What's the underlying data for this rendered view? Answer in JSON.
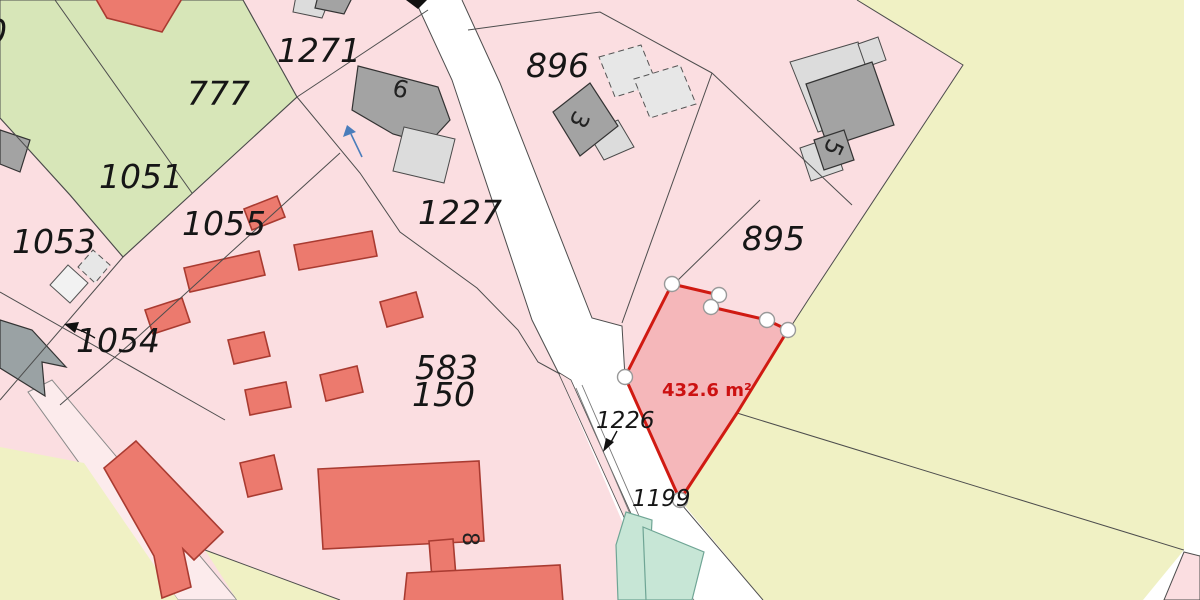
{
  "map": {
    "title": "Cadastral parcel map view",
    "parcel_labels": {
      "p0": "0",
      "p1271": "1271",
      "p777": "777",
      "p1051": "1051",
      "p1053": "1053",
      "p1054": "1054",
      "p1055": "1055",
      "p1227": "1227",
      "p896": "896",
      "p895": "895",
      "p583": "583",
      "p150": "150",
      "p1226": "1226",
      "p1199": "1199"
    },
    "building_labels": {
      "b9": "9",
      "b3": "3",
      "b5": "5",
      "b8": "8"
    },
    "highlighted_parcel": {
      "area_label": "432.6 m²",
      "vertex_count": 7,
      "fill": "#f5b7ba",
      "border": "#d01a12"
    },
    "colors": {
      "parcel_pink": "#fbdee1",
      "corridor_pink": "#fcebec",
      "parcel_green": "#d7e6b8",
      "parcel_yellow": "#f0f1c4",
      "road_white": "#ffffff",
      "building_red": "#ec7a6e",
      "building_dark_gray": "#a3a3a3",
      "building_light_gray": "#dcdcdc",
      "teal_feature": "#c7e6d6",
      "boundary_line": "#4d4d4d",
      "area_text": "#cc1111",
      "direction_arrow_blue": "#4a7dbb"
    },
    "icons": {
      "direction_arrow": "blue-direction-arrow",
      "leader_arrow_1054": "black-leader-arrow",
      "leader_arrow_1226": "black-leader-arrow"
    }
  }
}
